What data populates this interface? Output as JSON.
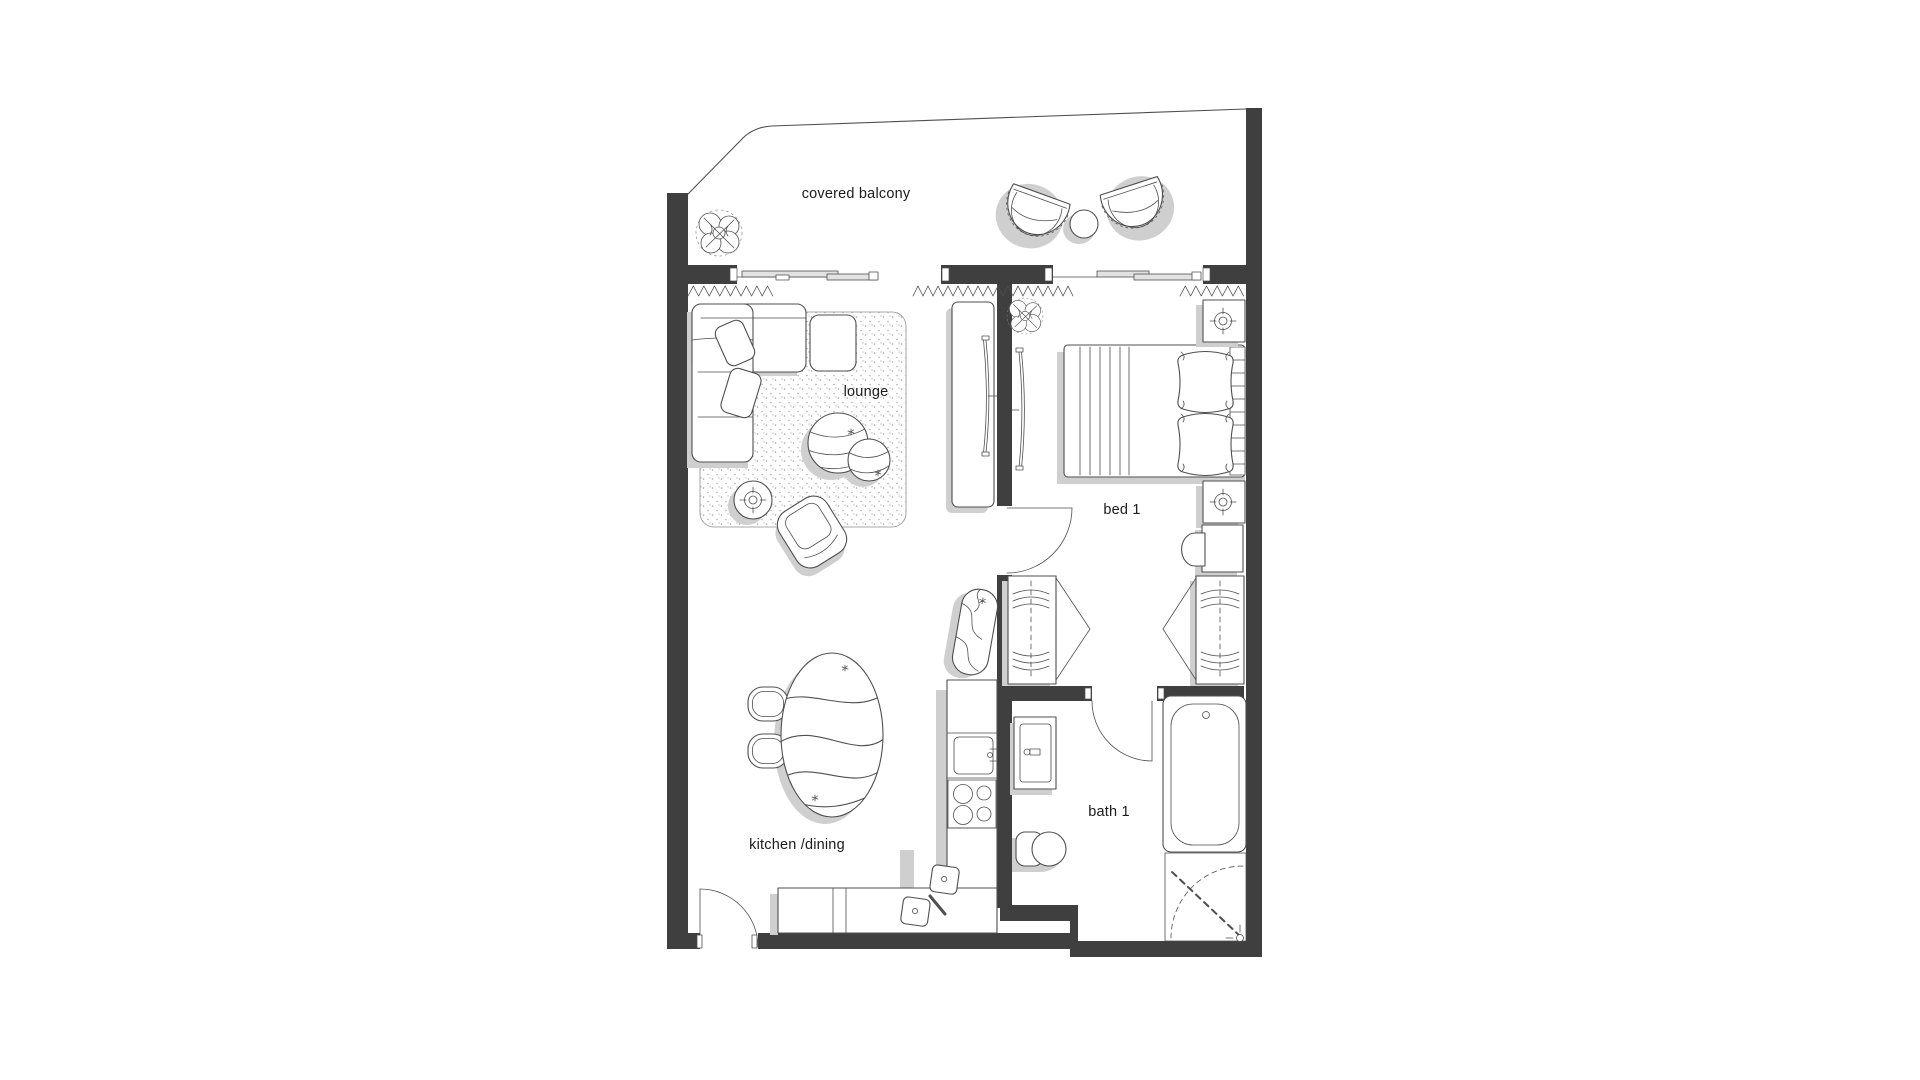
{
  "floor_plan": {
    "rooms": [
      {
        "id": "covered-balcony",
        "label": "covered balcony"
      },
      {
        "id": "lounge",
        "label": "lounge"
      },
      {
        "id": "bed-1",
        "label": "bed 1"
      },
      {
        "id": "bath-1",
        "label": "bath 1"
      },
      {
        "id": "kitchen-dining",
        "label": "kitchen /dining"
      }
    ],
    "colors": {
      "background": "#ffffff",
      "wall": "#3f3f3f",
      "line": "#4f4f4f",
      "shadow": "#cfcfcf",
      "glass": "#e2e2e2"
    }
  }
}
